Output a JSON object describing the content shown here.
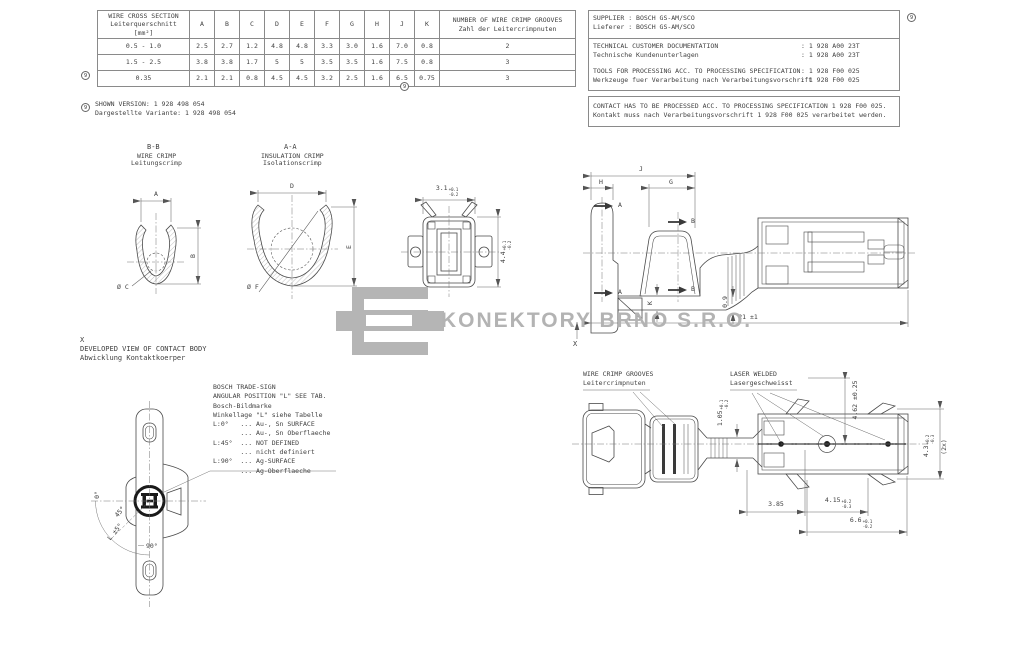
{
  "watermark": {
    "company": "KONEKTORY BRNO S.R.O."
  },
  "ref_marker": "9",
  "crimp_table": {
    "header_main": [
      "WIRE CROSS SECTION",
      "Leiterquerschnitt",
      "[mm²]"
    ],
    "dim_columns": [
      "A",
      "B",
      "C",
      "D",
      "E",
      "F",
      "G",
      "H",
      "J",
      "K"
    ],
    "header_grooves": [
      "NUMBER OF WIRE CRIMP GROOVES",
      "Zahl der Leitercrimpnuten"
    ],
    "rows": [
      {
        "cross_section": "0.5 - 1.0",
        "values": [
          "2.5",
          "2.7",
          "1.2",
          "4.8",
          "4.8",
          "3.3",
          "3.0",
          "1.6",
          "7.0",
          "0.8"
        ],
        "grooves": "2"
      },
      {
        "cross_section": "1.5 - 2.5",
        "values": [
          "3.8",
          "3.8",
          "1.7",
          "5",
          "5",
          "3.5",
          "3.5",
          "1.6",
          "7.5",
          "0.8"
        ],
        "grooves": "3"
      },
      {
        "cross_section": "0.35",
        "values": [
          "2.1",
          "2.1",
          "0.8",
          "4.5",
          "4.5",
          "3.2",
          "2.5",
          "1.6",
          "6.5",
          "0.75"
        ],
        "grooves": "3"
      }
    ]
  },
  "shown_version": {
    "en": "SHOWN VERSION: 1 928 498 054",
    "de": "Dargestellte Variante: 1 928 498 054"
  },
  "supplier_block": {
    "supplier_en": "SUPPLIER : BOSCH GS-AM/SCO",
    "supplier_de": "Lieferer : BOSCH GS-AM/SCO",
    "doc_en": "TECHNICAL CUSTOMER DOCUMENTATION",
    "doc_de": "Technische Kundenunterlagen",
    "doc_value": ": 1 928 A00 23T",
    "tools_en": "TOOLS FOR PROCESSING ACC. TO PROCESSING SPECIFICATION",
    "tools_de": "Werkzeuge fuer Verarbeitung nach Verarbeitungsvorschrift",
    "tools_value": ": 1 928 F00 025",
    "contact_en": "CONTACT HAS TO BE PROCESSED ACC. TO PROCESSING SPECIFICATION 1 928 F00 025.",
    "contact_de": "Kontakt muss nach Verarbeitungsvorschrift 1 928 F00 025 verarbeitet werden."
  },
  "section_bb": {
    "title": "B-B",
    "subtitle_en": "WIRE CRIMP",
    "subtitle_de": "Leitungscrimp",
    "dim_width": "A",
    "dim_height": "B",
    "dim_dia": "Ø C"
  },
  "section_aa": {
    "title": "A-A",
    "subtitle_en": "INSULATION CRIMP",
    "subtitle_de": "Isolationscrimp",
    "dim_width": "D",
    "dim_height": "E",
    "dim_dia": "Ø F"
  },
  "front_view": {
    "dim_width": {
      "v": "3.1",
      "p": "+0.1",
      "m": "-0.2"
    },
    "dim_height": {
      "v": "4.4",
      "p": "+0.1",
      "m": "-0.2"
    }
  },
  "side_view": {
    "dim_j": "J",
    "dim_h": "H",
    "dim_g": "G",
    "section_a": "A",
    "section_b": "B",
    "dim_k": "K",
    "dim_thickness": "0.9",
    "dim_length": "21 ±1",
    "view_mark": "X"
  },
  "developed_view": {
    "mark": "X",
    "title_en": "DEVELOPED VIEW OF CONTACT BODY",
    "title_de": "Abwicklung Kontaktkoerper",
    "angle_0": "0°",
    "angle_45": "45°",
    "angle_l": "L ±5°",
    "angle_90": "90°"
  },
  "trade_sign": {
    "lines": [
      "BOSCH TRADE-SIGN",
      "ANGULAR POSITION \"L\" SEE TAB.",
      "Bosch-Bildmarke",
      "Winkellage \"L\" siehe Tabelle",
      "L:0°   ... Au-, Sn SURFACE",
      "       ... Au-, Sn Oberflaeche",
      "L:45°  ... NOT DEFINED",
      "       ... nicht definiert",
      "L:90°  ... Ag-SURFACE",
      "       ... Ag-Oberflaeche"
    ]
  },
  "bottom_view": {
    "grooves_label_en": "WIRE CRIMP GROOVES",
    "grooves_label_de": "Leitercrimpnuten",
    "weld_label_en": "LASER WELDED",
    "weld_label_de": "Lasergeschweisst",
    "dim_neck": {
      "v": "1.05",
      "p": "+0.1",
      "m": "-0.2"
    },
    "dim_lance": "4.62 ±0.25",
    "dim_body": {
      "v": "4.3",
      "p": "+0.2",
      "m": "-0.3"
    },
    "dim_body_qty": "(2x)",
    "dim_a": "3.85",
    "dim_b": {
      "v": "4.15",
      "p": "+0.2",
      "m": "-0.3"
    },
    "dim_c": {
      "v": "6.6",
      "p": "+0.1",
      "m": "-0.2"
    }
  }
}
